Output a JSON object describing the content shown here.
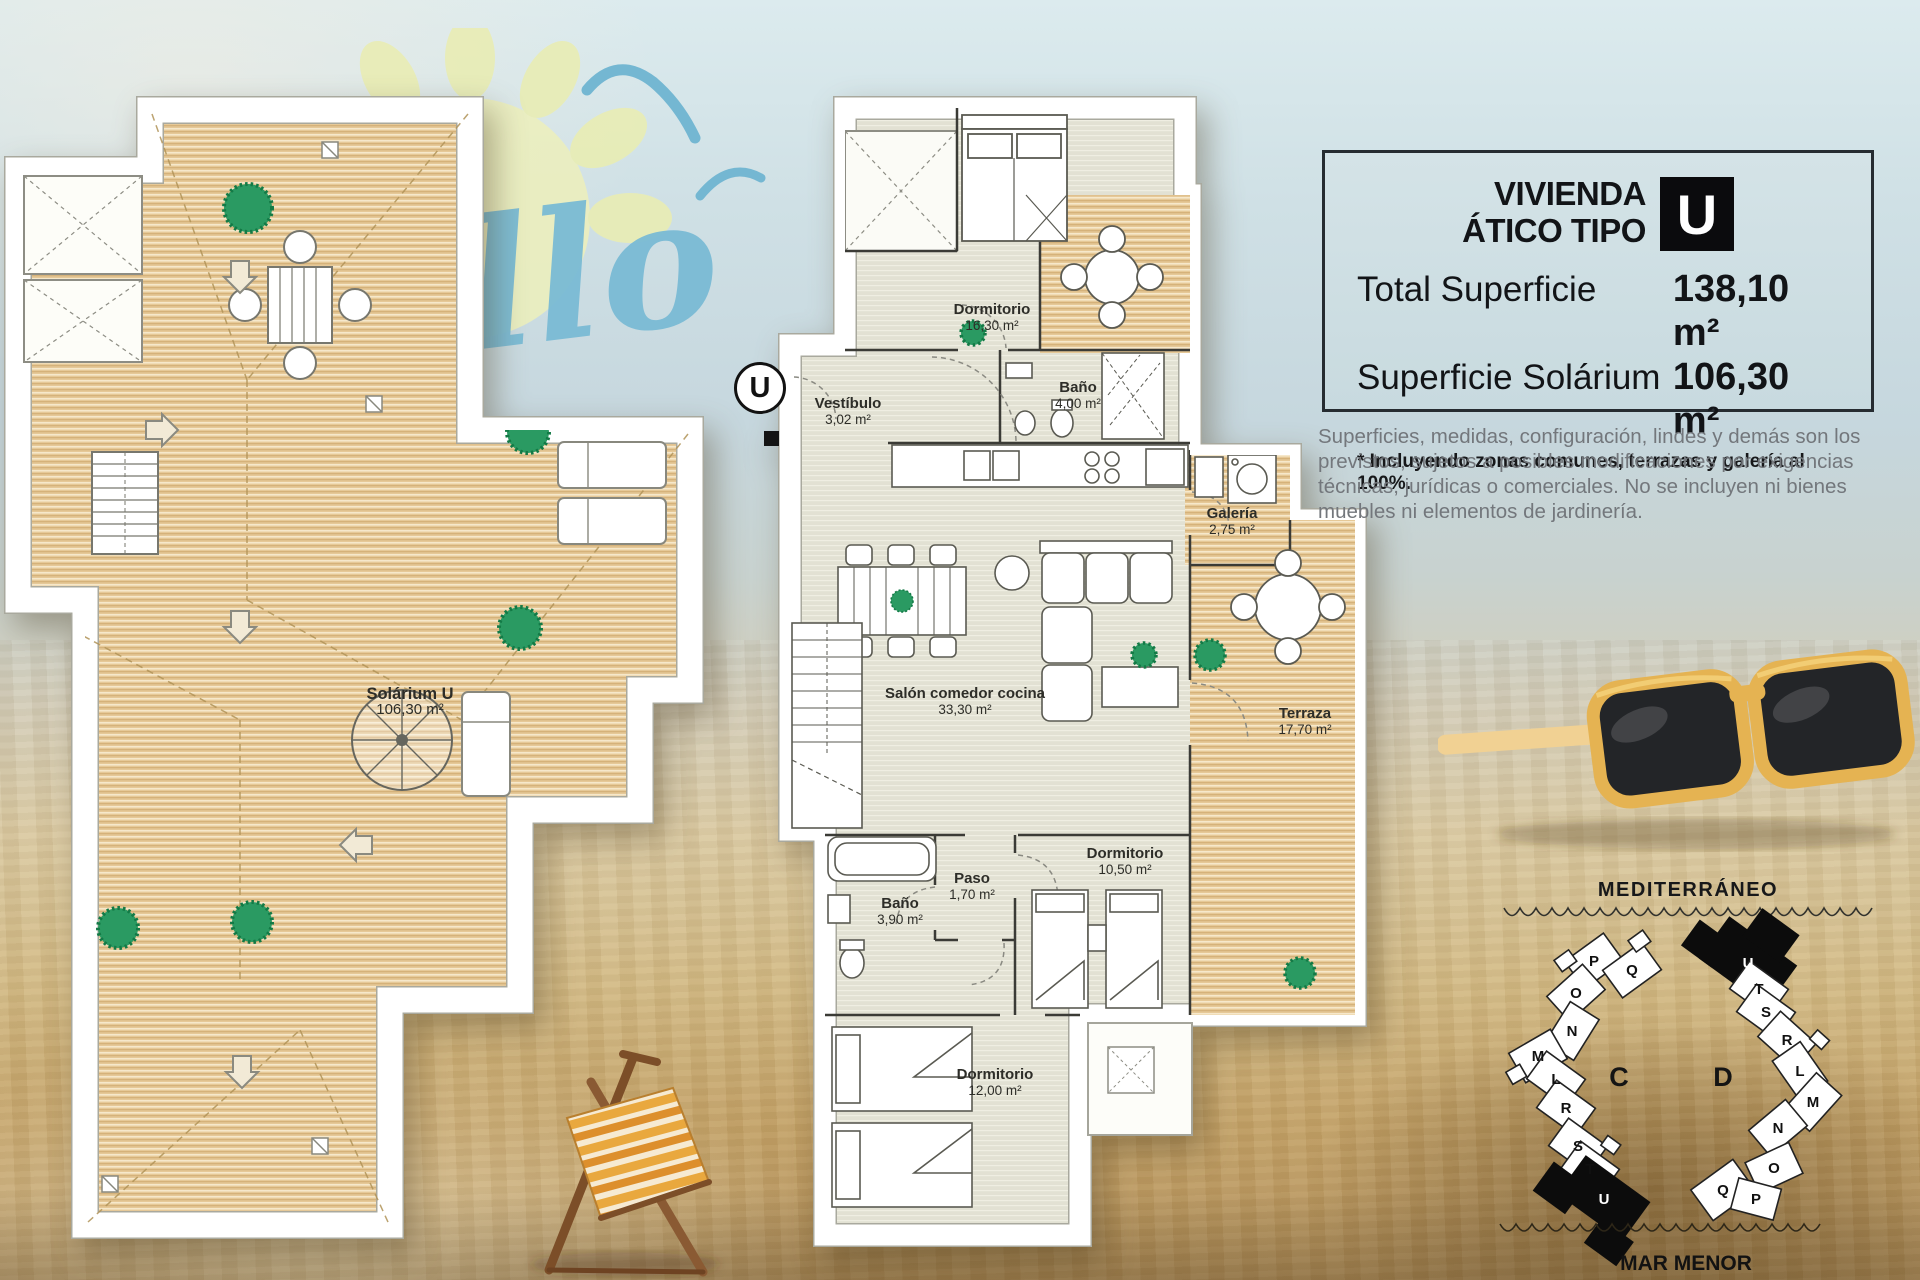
{
  "info_box": {
    "title_line1": "VIVIENDA",
    "title_line2": "ÁTICO TIPO",
    "type_letter": "U",
    "total_label": "Total Superficie",
    "total_value": "138,10 m²",
    "solarium_label": "Superficie Solárium",
    "solarium_value": "106,30 m²",
    "note": "* Incluyendo zonas comunes, terrazas y galería al 100%."
  },
  "disclaimer": "Superficies, medidas, configuración, lindes y demás son los previstos, sujetos a posibles modificaciones por exigencias técnicas, jurídicas o comerciales. No se incluyen ni bienes muebles ni elementos de jardinería.",
  "solarium": {
    "name": "Solárium U",
    "area": "106,30 m²"
  },
  "apartment": {
    "unit_marker": "U",
    "rooms": [
      {
        "name": "Dormitorio",
        "area": "16,30 m²"
      },
      {
        "name": "Vestíbulo",
        "area": "3,02 m²"
      },
      {
        "name": "Baño",
        "area": "4,00 m²"
      },
      {
        "name": "Galería",
        "area": "2,75 m²"
      },
      {
        "name": "Salón comedor cocina",
        "area": "33,30 m²"
      },
      {
        "name": "Terraza",
        "area": "17,70 m²"
      },
      {
        "name": "Dormitorio",
        "area": "10,50 m²"
      },
      {
        "name": "Paso",
        "area": "1,70 m²"
      },
      {
        "name": "Baño",
        "area": "3,90 m²"
      },
      {
        "name": "Dormitorio",
        "area": "12,00 m²"
      }
    ]
  },
  "site_map": {
    "sea_top": "MEDITERRÁNEO",
    "sea_bottom": "MAR MENOR",
    "block_c": {
      "label": "C",
      "highlighted": "U",
      "units": [
        "P",
        "Q",
        "O",
        "N",
        "M",
        "L",
        "R",
        "S",
        "T",
        "U"
      ]
    },
    "block_d": {
      "label": "D",
      "highlighted": "U",
      "units": [
        "U",
        "T",
        "S",
        "R",
        "L",
        "M",
        "N",
        "O",
        "Q",
        "P"
      ]
    }
  },
  "watermark": {
    "script_text": "llo"
  },
  "colors": {
    "info_box_bg": "#cddde2",
    "info_box_border": "#262c31",
    "deck_tan": "#e6c998",
    "interior_floor": "#e2e1d3",
    "plant_green": "#2a9a62",
    "sunglasses_yellow": "#e5b352",
    "watermark_blue": "#7abbd5",
    "sky": "#d2e2e7",
    "sand": "#c2a470"
  }
}
